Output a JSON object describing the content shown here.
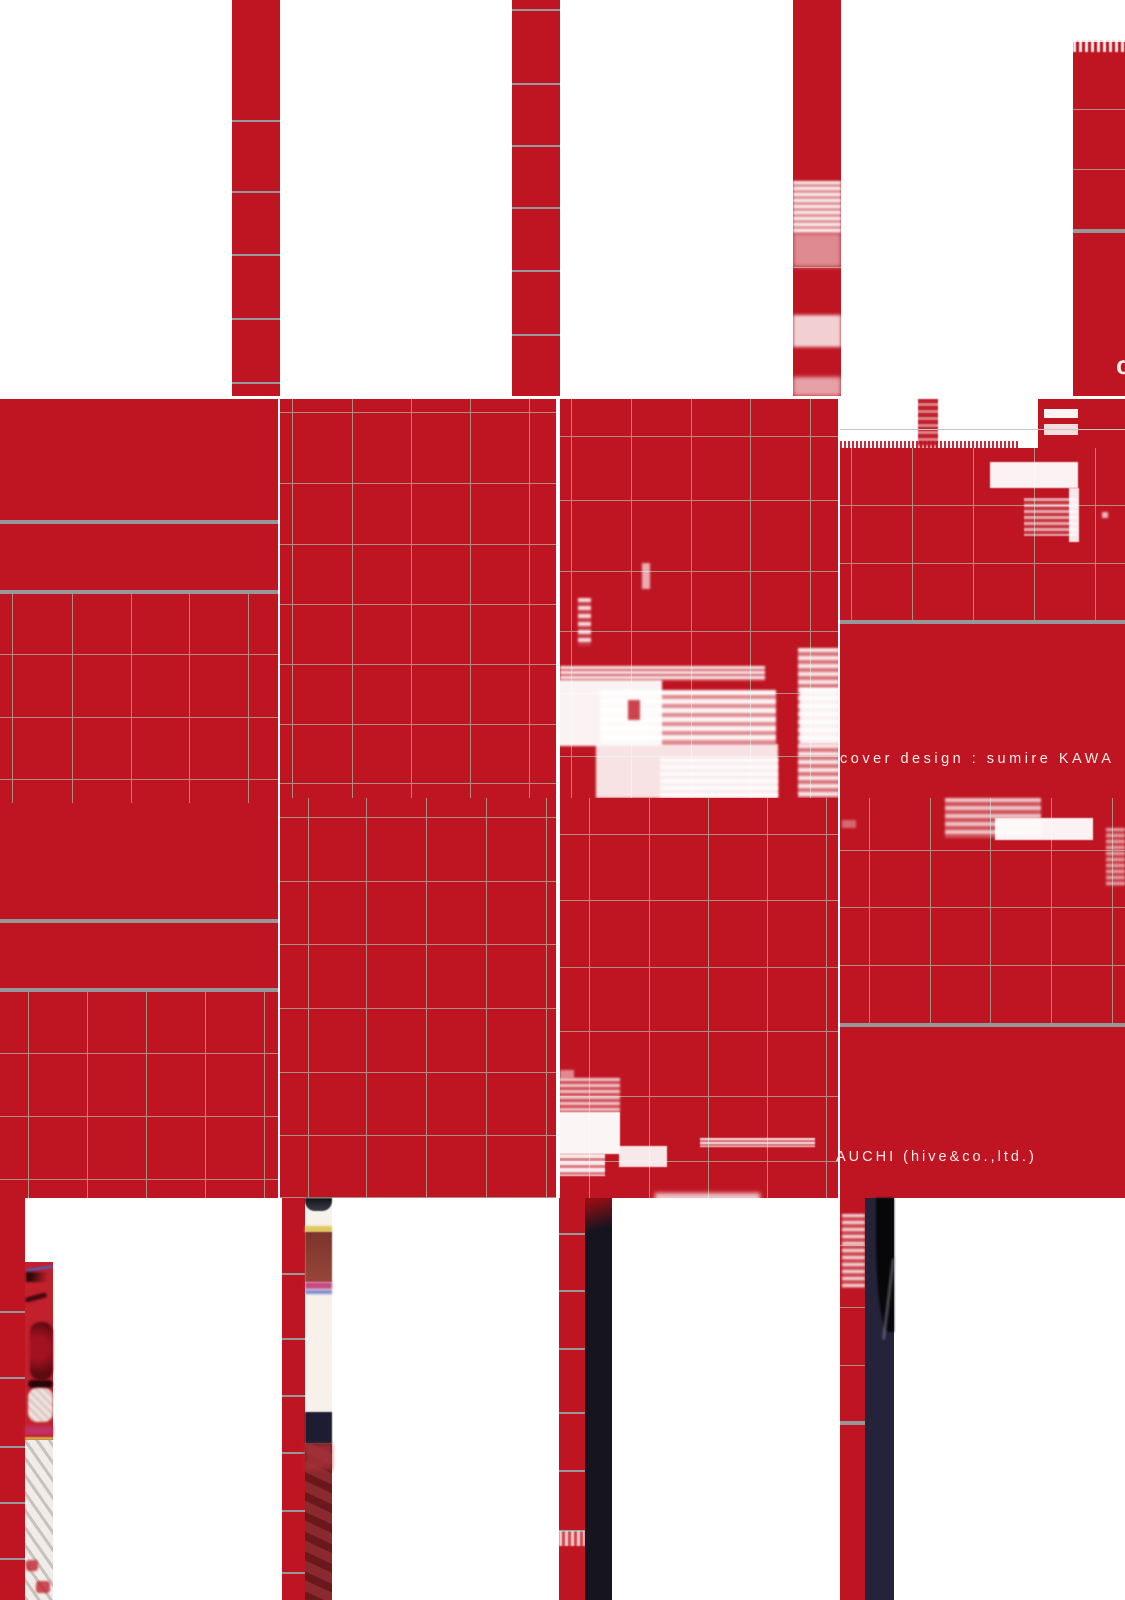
{
  "texts": {
    "cover_design_credit": "cover design : sumire KAWA",
    "company_credit": "AUCHI (hive&co.,ltd.)",
    "clipped_letter": "c"
  },
  "palette": {
    "red": "#bf1522",
    "red_bright": "#c1202c",
    "fine_line": "#b08d80",
    "fine_line_gray": "#c4c6c8",
    "thick_line": "#96989c",
    "navy": "#242339",
    "navy_dark": "#15141f",
    "black": "#070709",
    "white": "#ffffff",
    "cream": "#f6f1ea",
    "text_white": "#f3ece8"
  },
  "scene": [
    {
      "n": "row1-strip-a",
      "x": 232,
      "y": 0,
      "w": 48,
      "h": 396,
      "c": "red"
    },
    {
      "n": "row1-strip-a-lines",
      "t": "grid",
      "x": 232,
      "y": 0,
      "w": 48,
      "h": 396,
      "hy": [
        120,
        191,
        254,
        318,
        382
      ],
      "c": "thick_line",
      "lw": 2
    },
    {
      "n": "row1-strip-b",
      "x": 512,
      "y": 0,
      "w": 48,
      "h": 396,
      "c": "red"
    },
    {
      "n": "row1-strip-b-lines",
      "t": "grid",
      "x": 512,
      "y": 0,
      "w": 48,
      "h": 396,
      "hy": [
        9,
        83,
        145,
        207,
        270,
        334
      ],
      "c": "thick_line",
      "lw": 2
    },
    {
      "n": "row1-strip-c",
      "x": 793,
      "y": 0,
      "w": 48,
      "h": 396,
      "c": "red"
    },
    {
      "n": "row1-strip-c-lines",
      "t": "grid",
      "x": 793,
      "y": 0,
      "w": 48,
      "h": 396,
      "hy": [
        267
      ],
      "c": "fine_line"
    },
    {
      "n": "glitch-strip-c-1",
      "x": 793,
      "y": 181,
      "w": 48,
      "h": 52,
      "bg": "repeating-linear-gradient(180deg, rgba(255,255,255,0.95) 0 3px, rgba(255,255,255,0.5) 3px 6px)",
      "b": 1
    },
    {
      "n": "glitch-strip-c-2",
      "x": 793,
      "y": 233,
      "w": 48,
      "h": 34,
      "c": "white",
      "o": 0.5,
      "b": 2
    },
    {
      "n": "glitch-strip-c-3",
      "x": 793,
      "y": 315,
      "w": 48,
      "h": 32,
      "c": "white",
      "o": 0.8,
      "b": 1.5
    },
    {
      "n": "glitch-strip-c-4",
      "x": 793,
      "y": 377,
      "w": 48,
      "h": 19,
      "c": "white",
      "o": 0.6,
      "b": 2
    },
    {
      "n": "row1-block-d",
      "x": 1073,
      "y": 42,
      "w": 52,
      "h": 354,
      "c": "red"
    },
    {
      "n": "row1-block-d-noise",
      "x": 1073,
      "y": 40,
      "w": 52,
      "h": 12,
      "bg": "repeating-linear-gradient(90deg, rgba(255,255,255,0.9) 0 3px, rgba(191,21,34,0.2) 3px 6px)",
      "b": 0.5
    },
    {
      "n": "row1-block-d-lines",
      "t": "grid",
      "x": 1073,
      "y": 42,
      "w": 52,
      "h": 354,
      "hy": [
        109,
        169
      ],
      "c": "fine_line"
    },
    {
      "n": "row1-block-d-thick",
      "x": 1073,
      "y": 229,
      "w": 52,
      "h": 4,
      "c": "thick_line"
    },
    {
      "n": "row2-tile-1",
      "x": 0,
      "y": 399,
      "w": 278,
      "h": 399,
      "c": "red"
    },
    {
      "n": "row2-tile-1-thick-a",
      "x": 0,
      "y": 520,
      "w": 278,
      "h": 4,
      "c": "thick_line"
    },
    {
      "n": "row2-tile-1-thick-b",
      "x": 0,
      "y": 590,
      "w": 278,
      "h": 4,
      "c": "thick_line"
    },
    {
      "n": "row2-tile-1-grid",
      "t": "grid",
      "x": 0,
      "y": 594,
      "w": 278,
      "h": 204,
      "vx": [
        12,
        72,
        131,
        189,
        248
      ],
      "hy": [
        654,
        717,
        779
      ],
      "c": "fine_line"
    },
    {
      "n": "row2-tile-2",
      "x": 280,
      "y": 399,
      "w": 276,
      "h": 399,
      "c": "red"
    },
    {
      "n": "row2-tile-2-grid",
      "t": "grid",
      "x": 280,
      "y": 399,
      "w": 276,
      "h": 399,
      "vx": [
        292,
        352,
        411,
        470,
        529
      ],
      "hy": [
        412,
        483,
        544,
        604,
        664,
        724,
        783
      ],
      "c": "fine_line"
    },
    {
      "n": "row2-tile-3",
      "x": 560,
      "y": 399,
      "w": 278,
      "h": 399,
      "c": "red"
    },
    {
      "n": "row2-tile-3-grid",
      "t": "grid",
      "x": 560,
      "y": 399,
      "w": 278,
      "h": 399,
      "vx": [
        571,
        631,
        691,
        750,
        810
      ],
      "hy": [
        436,
        500,
        571,
        631,
        693,
        756
      ],
      "c": "fine_line"
    },
    {
      "n": "glitch-t3-speck",
      "x": 642,
      "y": 563,
      "w": 8,
      "h": 26,
      "c": "white",
      "o": 0.65,
      "b": 1
    },
    {
      "n": "glitch-t3-dashcol",
      "x": 578,
      "y": 598,
      "w": 13,
      "h": 48,
      "bg": "repeating-linear-gradient(180deg, rgba(255,255,255,0.85) 0 4px, rgba(255,255,255,0.15) 4px 8px)",
      "b": 1
    },
    {
      "n": "glitch-t3-streak",
      "x": 560,
      "y": 666,
      "w": 205,
      "h": 15,
      "bg": "repeating-linear-gradient(180deg, rgba(255,255,255,0.9) 0 3px, rgba(255,255,255,0.3) 3px 5px)",
      "b": 1
    },
    {
      "n": "glitch-t3-big",
      "x": 558,
      "y": 680,
      "w": 104,
      "h": 66,
      "c": "white",
      "o": 0.95,
      "b": 1
    },
    {
      "n": "glitch-t3-mid",
      "x": 600,
      "y": 690,
      "w": 176,
      "h": 54,
      "bg": "repeating-linear-gradient(180deg, rgba(255,255,255,0.95) 0 5px, rgba(255,255,255,0.5) 5px 9px)",
      "b": 1
    },
    {
      "n": "glitch-t3-redspeck",
      "x": 628,
      "y": 700,
      "w": 12,
      "h": 20,
      "c": "red",
      "o": 0.8,
      "b": 1
    },
    {
      "n": "glitch-t3-bottom",
      "x": 596,
      "y": 744,
      "w": 182,
      "h": 54,
      "c": "white",
      "o": 0.88,
      "b": 1
    },
    {
      "n": "glitch-t3-bottom2",
      "x": 660,
      "y": 758,
      "w": 118,
      "h": 40,
      "bg": "repeating-linear-gradient(180deg, rgba(255,255,255,0.85) 0 4px, rgba(255,255,255,0.35) 4px 7px)",
      "b": 1
    },
    {
      "n": "glitch-t3-rightcol",
      "x": 798,
      "y": 648,
      "w": 41,
      "h": 150,
      "bg": "repeating-linear-gradient(180deg, rgba(255,255,255,0.9) 0 4px, rgba(255,255,255,0.4) 4px 8px)",
      "b": 1
    },
    {
      "n": "glitch-t3-rightcol2",
      "x": 800,
      "y": 688,
      "w": 39,
      "h": 56,
      "c": "white",
      "o": 0.9,
      "b": 1
    },
    {
      "n": "row2-tile-4",
      "x": 840,
      "y": 399,
      "w": 285,
      "h": 399,
      "c": "red"
    },
    {
      "n": "row2-tile-4-white-band",
      "x": 840,
      "y": 399,
      "w": 285,
      "h": 49,
      "c": "white"
    },
    {
      "n": "t4-band-red-col",
      "x": 918,
      "y": 399,
      "w": 20,
      "h": 49,
      "bg": "repeating-linear-gradient(180deg, rgba(191,21,34,0.95) 0 4px, rgba(191,21,34,0.55) 4px 7px)",
      "b": 0.5
    },
    {
      "n": "t4-band-red-mass",
      "x": 1038,
      "y": 399,
      "w": 87,
      "h": 49,
      "c": "red"
    },
    {
      "n": "t4-band-slot-1",
      "x": 1044,
      "y": 409,
      "w": 34,
      "h": 9,
      "c": "white",
      "o": 0.95
    },
    {
      "n": "t4-band-slot-2",
      "x": 1044,
      "y": 424,
      "w": 34,
      "h": 11,
      "c": "white",
      "o": 0.85
    },
    {
      "n": "t4-grayline-onwhite",
      "x": 840,
      "y": 429,
      "w": 285,
      "h": 1,
      "c": "fine_line_gray"
    },
    {
      "n": "t4-edge-halftone",
      "x": 840,
      "y": 441,
      "w": 180,
      "h": 8,
      "bg": "repeating-linear-gradient(90deg, rgba(191,21,34,0.9) 0 2px, rgba(191,21,34,0) 2px 4px)"
    },
    {
      "n": "row2-tile-4-grid",
      "t": "grid",
      "x": 840,
      "y": 448,
      "w": 285,
      "h": 174,
      "vx": [
        851,
        912,
        973,
        1034,
        1095
      ],
      "hy": [
        505,
        563
      ],
      "c": "fine_line"
    },
    {
      "n": "row2-tile-4-thick",
      "x": 840,
      "y": 620,
      "w": 285,
      "h": 4,
      "c": "thick_line"
    },
    {
      "n": "glitch-t4-slab",
      "x": 990,
      "y": 462,
      "w": 88,
      "h": 26,
      "c": "white",
      "o": 0.95,
      "b": 0.5
    },
    {
      "n": "glitch-t4-sliver",
      "x": 1069,
      "y": 488,
      "w": 10,
      "h": 54,
      "c": "white",
      "o": 0.9,
      "b": 0.5
    },
    {
      "n": "glitch-t4-halftone",
      "x": 1024,
      "y": 498,
      "w": 54,
      "h": 38,
      "bg": "repeating-linear-gradient(180deg, rgba(255,255,255,0.6) 0 3px, rgba(255,255,255,0.15) 3px 6px)",
      "b": 0.5
    },
    {
      "n": "glitch-t4-dot",
      "x": 1102,
      "y": 512,
      "w": 6,
      "h": 6,
      "c": "white",
      "o": 0.7,
      "b": 1
    },
    {
      "n": "row3-tile-1",
      "x": 0,
      "y": 798,
      "w": 278,
      "h": 400,
      "c": "red"
    },
    {
      "n": "row3-tile-1-stubs",
      "t": "grid",
      "x": 0,
      "y": 798,
      "w": 278,
      "h": 5,
      "vx": [
        12,
        72,
        131,
        189,
        248
      ],
      "c": "fine_line"
    },
    {
      "n": "row3-tile-1-thick-a",
      "x": 0,
      "y": 919,
      "w": 278,
      "h": 4,
      "c": "thick_line"
    },
    {
      "n": "row3-tile-1-thick-b",
      "x": 0,
      "y": 988,
      "w": 278,
      "h": 4,
      "c": "thick_line"
    },
    {
      "n": "row3-tile-1-grid",
      "t": "grid",
      "x": 0,
      "y": 992,
      "w": 278,
      "h": 206,
      "vx": [
        28,
        87,
        146,
        205,
        264
      ],
      "hy": [
        1053,
        1116,
        1179
      ],
      "c": "fine_line"
    },
    {
      "n": "row3-tile-2",
      "x": 280,
      "y": 798,
      "w": 276,
      "h": 400,
      "c": "red"
    },
    {
      "n": "row3-tile-2-grid",
      "t": "grid",
      "x": 280,
      "y": 798,
      "w": 276,
      "h": 400,
      "vx": [
        308,
        366,
        426,
        486,
        546
      ],
      "hy": [
        817,
        881,
        944,
        1008,
        1072,
        1135,
        1197
      ],
      "c": "fine_line"
    },
    {
      "n": "row3-tile-3",
      "x": 560,
      "y": 798,
      "w": 278,
      "h": 400,
      "c": "red"
    },
    {
      "n": "row3-tile-3-grid",
      "t": "grid",
      "x": 560,
      "y": 798,
      "w": 278,
      "h": 400,
      "vx": [
        589,
        649,
        708,
        767,
        826
      ],
      "hy": [
        834,
        900,
        967,
        1031,
        1096,
        1161
      ],
      "c": "fine_line"
    },
    {
      "n": "glitch-r3t3-speck",
      "x": 560,
      "y": 1070,
      "w": 14,
      "h": 8,
      "c": "white",
      "o": 0.5,
      "b": 1
    },
    {
      "n": "glitch-r3t3-halftone",
      "x": 559,
      "y": 1078,
      "w": 61,
      "h": 34,
      "bg": "repeating-linear-gradient(180deg, rgba(255,255,255,0.8) 0 3px, rgba(255,200,195,0.25) 3px 6px)",
      "b": 1
    },
    {
      "n": "glitch-r3t3-block",
      "x": 559,
      "y": 1112,
      "w": 61,
      "h": 42,
      "c": "white",
      "o": 0.96,
      "b": 0.5
    },
    {
      "n": "glitch-r3t3-block2",
      "x": 559,
      "y": 1154,
      "w": 46,
      "h": 22,
      "bg": "repeating-linear-gradient(180deg, rgba(255,255,255,0.9) 0 4px, rgba(255,255,255,0.45) 4px 7px)",
      "b": 0.5
    },
    {
      "n": "glitch-r3t3-bar",
      "x": 619,
      "y": 1146,
      "w": 48,
      "h": 21,
      "c": "white",
      "o": 0.9,
      "b": 0.5
    },
    {
      "n": "glitch-r3t3-streak",
      "x": 700,
      "y": 1138,
      "w": 115,
      "h": 9,
      "bg": "repeating-linear-gradient(180deg, rgba(255,255,255,0.85) 0 2px, rgba(255,255,255,0.35) 2px 4px)",
      "b": 0.5
    },
    {
      "n": "row3-tile-4",
      "x": 840,
      "y": 798,
      "w": 285,
      "h": 400,
      "c": "red"
    },
    {
      "n": "row3-tile-4-grid",
      "t": "grid",
      "x": 840,
      "y": 798,
      "w": 285,
      "h": 227,
      "vx": [
        869,
        930,
        990,
        1051,
        1112
      ],
      "hy": [
        850,
        907,
        965
      ],
      "c": "fine_line"
    },
    {
      "n": "row3-tile-4-thick",
      "x": 840,
      "y": 1023,
      "w": 285,
      "h": 4,
      "c": "thick_line"
    },
    {
      "n": "glitch-r3t4-bar",
      "x": 945,
      "y": 798,
      "w": 96,
      "h": 40,
      "bg": "repeating-linear-gradient(180deg, rgba(255,255,255,0.75) 0 4px, rgba(255,255,255,0.25) 4px 8px)",
      "b": 1
    },
    {
      "n": "glitch-r3t4-bright",
      "x": 995,
      "y": 818,
      "w": 98,
      "h": 22,
      "c": "white",
      "o": 0.95,
      "b": 0.5
    },
    {
      "n": "glitch-r3t4-rightnoise",
      "x": 1106,
      "y": 828,
      "w": 19,
      "h": 58,
      "bg": "repeating-linear-gradient(180deg, rgba(255,255,255,0.6) 0 3px, rgba(255,255,255,0.15) 3px 6px)",
      "b": 1
    },
    {
      "n": "glitch-r3t4-reddash",
      "x": 842,
      "y": 820,
      "w": 14,
      "h": 8,
      "c": "white",
      "o": 0.35,
      "b": 1
    },
    {
      "n": "row4-red-col-a",
      "x": 0,
      "y": 1198,
      "w": 25,
      "h": 402,
      "c": "red"
    },
    {
      "n": "row4-red-col-a-lines",
      "t": "grid",
      "x": 0,
      "y": 1198,
      "w": 25,
      "h": 402,
      "hy": [
        1311,
        1377,
        1446,
        1502,
        1558
      ],
      "c": "thick_line",
      "lw": 2
    },
    {
      "n": "photo-strip-a-top",
      "x": 25,
      "y": 1198,
      "w": 28,
      "h": 64,
      "c": "white"
    },
    {
      "n": "photo-strip-a-swirl",
      "x": 25,
      "y": 1262,
      "w": 28,
      "h": 178,
      "c": "red_bright"
    },
    {
      "n": "swirl-blue-arc",
      "x": 26,
      "y": 1267,
      "w": 27,
      "h": 3,
      "c": "#4a5fc2",
      "o": 0.8,
      "b": 0.5,
      "r": 4,
      "rot": -8
    },
    {
      "n": "swirl-dark-arc-1",
      "x": 26,
      "y": 1272,
      "w": 27,
      "h": 10,
      "bg": "linear-gradient(100deg, #2f070b 20%, rgba(47,7,11,0) 80%)",
      "b": 1
    },
    {
      "n": "swirl-dark-arc-2",
      "x": 25,
      "y": 1295,
      "w": 22,
      "h": 5,
      "c": "#42080e",
      "r": 4,
      "b": 1,
      "rot": -15
    },
    {
      "n": "swirl-core",
      "x": 30,
      "y": 1322,
      "w": 23,
      "h": 58,
      "bg": "radial-gradient(circle at 35% 45%, #a31220 30%, #5d0a10 75%)",
      "r": 10,
      "b": 1
    },
    {
      "n": "swirl-eye-rim",
      "x": 28,
      "y": 1380,
      "w": 25,
      "h": 8,
      "c": "#2a0608",
      "r": 4,
      "b": 1
    },
    {
      "n": "swirl-eye-white",
      "x": 28,
      "y": 1388,
      "w": 25,
      "h": 34,
      "bg": "repeating-linear-gradient(45deg, #ece4df 0 4px, #d9b8b4 4px 6px)",
      "r": 9,
      "b": 1
    },
    {
      "n": "swirl-magenta",
      "x": 25,
      "y": 1426,
      "w": 28,
      "h": 9,
      "c": "#c2356f",
      "o": 0.85,
      "b": 1.5
    },
    {
      "n": "swirl-yellow-line",
      "x": 25,
      "y": 1437,
      "w": 28,
      "h": 3,
      "c": "#d8c24a",
      "o": 0.85,
      "b": 0.5
    },
    {
      "n": "photo-strip-a-stripes",
      "x": 25,
      "y": 1440,
      "w": 28,
      "h": 160,
      "bg": "repeating-linear-gradient(55deg, #c8c2bc 0 3px, #efecea 3px 10px)"
    },
    {
      "n": "photo-strip-a-dot-1",
      "x": 26,
      "y": 1560,
      "w": 12,
      "h": 11,
      "c": "red_bright",
      "r": 3,
      "b": 1,
      "o": 0.8
    },
    {
      "n": "photo-strip-a-dot-2",
      "x": 36,
      "y": 1581,
      "w": 14,
      "h": 12,
      "c": "red_bright",
      "r": 3,
      "b": 1,
      "o": 0.8
    },
    {
      "n": "row4-red-col-b",
      "x": 282,
      "y": 1198,
      "w": 23,
      "h": 402,
      "c": "red"
    },
    {
      "n": "row4-red-col-b-lines",
      "t": "grid",
      "x": 282,
      "y": 1198,
      "w": 23,
      "h": 402,
      "hy": [
        1273,
        1338,
        1395,
        1452,
        1510,
        1572
      ],
      "c": "thick_line",
      "lw": 2
    },
    {
      "n": "photo-strip-b",
      "x": 305,
      "y": 1198,
      "w": 27,
      "h": 402,
      "c": "cream"
    },
    {
      "n": "pb-top-dark",
      "x": 305,
      "y": 1198,
      "w": 27,
      "h": 13,
      "bg": "linear-gradient(to bottom, #13131b, #3c3c46)",
      "r": "0 0 10px 10px",
      "b": 0.5
    },
    {
      "n": "pb-fringe-yellow",
      "x": 305,
      "y": 1226,
      "w": 27,
      "h": 7,
      "c": "#ddc24e",
      "o": 0.9,
      "b": 1
    },
    {
      "n": "pb-band",
      "x": 305,
      "y": 1232,
      "w": 27,
      "h": 50,
      "bg": "linear-gradient(to bottom, #7c342c, #97463a)",
      "b": 0.5
    },
    {
      "n": "pb-fringe-magenta",
      "x": 305,
      "y": 1282,
      "w": 27,
      "h": 7,
      "c": "#c13a78",
      "o": 0.9,
      "b": 1
    },
    {
      "n": "pb-fringe-blue",
      "x": 305,
      "y": 1290,
      "w": 27,
      "h": 4,
      "c": "#4a5fc2",
      "o": 0.7,
      "b": 1
    },
    {
      "n": "pb-navy-band",
      "x": 305,
      "y": 1412,
      "w": 27,
      "h": 32,
      "c": "#1d1c30",
      "b": 0.5
    },
    {
      "n": "pb-maroon",
      "x": 305,
      "y": 1444,
      "w": 27,
      "h": 156,
      "bg": "repeating-linear-gradient(25deg, #6b181d 0 8px, #8a2a2e 8px 18px)"
    },
    {
      "n": "pb-maroon-light",
      "x": 305,
      "y": 1444,
      "w": 27,
      "h": 26,
      "c": "#a63238",
      "o": 0.8,
      "b": 2
    },
    {
      "n": "row4-red-col-c",
      "x": 559,
      "y": 1198,
      "w": 26,
      "h": 402,
      "c": "red"
    },
    {
      "n": "row4-red-col-c-lines",
      "t": "grid",
      "x": 559,
      "y": 1198,
      "w": 26,
      "h": 402,
      "hy": [
        1233,
        1290,
        1348,
        1412,
        1470,
        1530
      ],
      "c": "thick_line",
      "lw": 2
    },
    {
      "n": "glitch-col-c",
      "x": 559,
      "y": 1531,
      "w": 26,
      "h": 15,
      "bg": "repeating-linear-gradient(90deg, rgba(255,230,228,0.85) 0 3px, rgba(255,230,228,0.25) 3px 6px)",
      "b": 0.5
    },
    {
      "n": "row4-dark-col-a",
      "x": 585,
      "y": 1198,
      "w": 27,
      "h": 402,
      "c": "navy_dark"
    },
    {
      "n": "dark-col-a-red-fade",
      "x": 585,
      "y": 1198,
      "w": 27,
      "h": 44,
      "bg": "linear-gradient(165deg, rgba(150,14,20,0.95) 10%, rgba(20,10,14,0) 70%)"
    },
    {
      "n": "row4-red-col-d",
      "x": 840,
      "y": 1198,
      "w": 25,
      "h": 402,
      "c": "red"
    },
    {
      "n": "row4-red-col-d-lines",
      "t": "grid",
      "x": 840,
      "y": 1198,
      "w": 25,
      "h": 402,
      "hy": [
        1245,
        1307,
        1365
      ],
      "c": "fine_line"
    },
    {
      "n": "row4-red-col-d-thick",
      "x": 840,
      "y": 1421,
      "w": 25,
      "h": 4,
      "c": "thick_line"
    },
    {
      "n": "glitch-col-d",
      "x": 842,
      "y": 1214,
      "w": 23,
      "h": 74,
      "bg": "repeating-linear-gradient(180deg, rgba(255,255,255,0.85) 0 3px, rgba(255,255,255,0.2) 3px 7px)",
      "b": 1
    },
    {
      "n": "row4-dark-col-b",
      "x": 865,
      "y": 1198,
      "w": 29,
      "h": 402,
      "c": "navy"
    },
    {
      "n": "dark-col-b-blob",
      "x": 876,
      "y": 1198,
      "w": 18,
      "h": 134,
      "c": "black",
      "r": "0 0 0 70%",
      "b": 1
    },
    {
      "n": "dark-col-b-curve",
      "x": 887,
      "y": 1258,
      "w": 3,
      "h": 82,
      "c": "#8a8aa2",
      "o": 0.5,
      "b": 1,
      "r": 4,
      "rot": 7
    },
    {
      "n": "boundary-smear",
      "x": 655,
      "y": 1193,
      "w": 105,
      "h": 9,
      "c": "white",
      "o": 0.75,
      "b": 2
    }
  ]
}
